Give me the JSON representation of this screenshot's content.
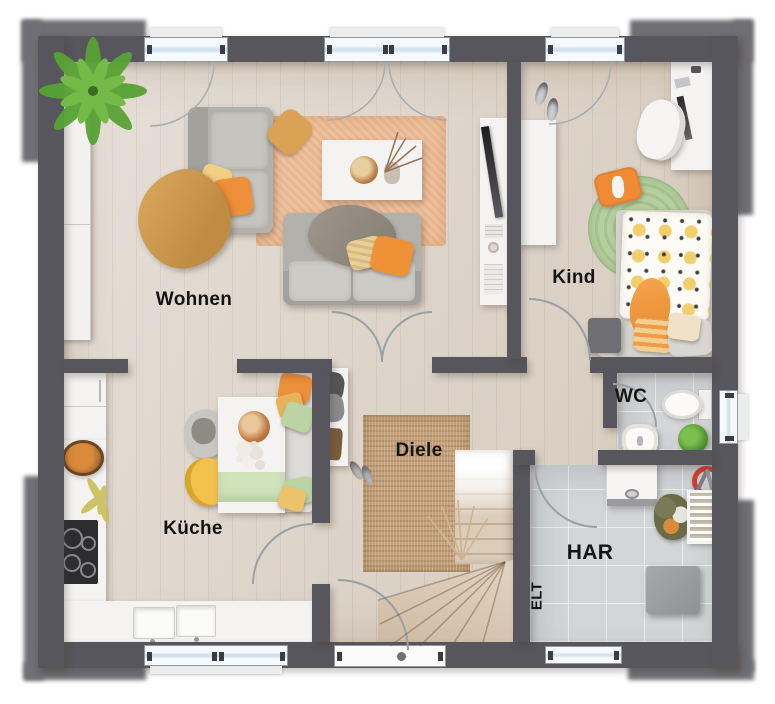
{
  "rooms": {
    "living": {
      "label": "Wohnen"
    },
    "child": {
      "label": "Kind"
    },
    "kitchen": {
      "label": "Küche"
    },
    "hall": {
      "label": "Diele"
    },
    "wc": {
      "label": "WC"
    },
    "utility": {
      "label": "HAR"
    },
    "electrical": {
      "label": "ELT"
    }
  },
  "colors": {
    "wall": "#57565c",
    "corner_stone": "#6f6f74",
    "wood_floor": "#dbd2c7",
    "tile_floor": "#d3d5d7",
    "hall_rug": "#c4a078",
    "living_rug": "#e9b68e",
    "child_rug": "#b6cf9f",
    "accent_orange": "#ee8f3a",
    "accent_yellow": "#f0c466",
    "accent_green": "#bcd4a4",
    "window_glass": "#cfe2ee"
  }
}
